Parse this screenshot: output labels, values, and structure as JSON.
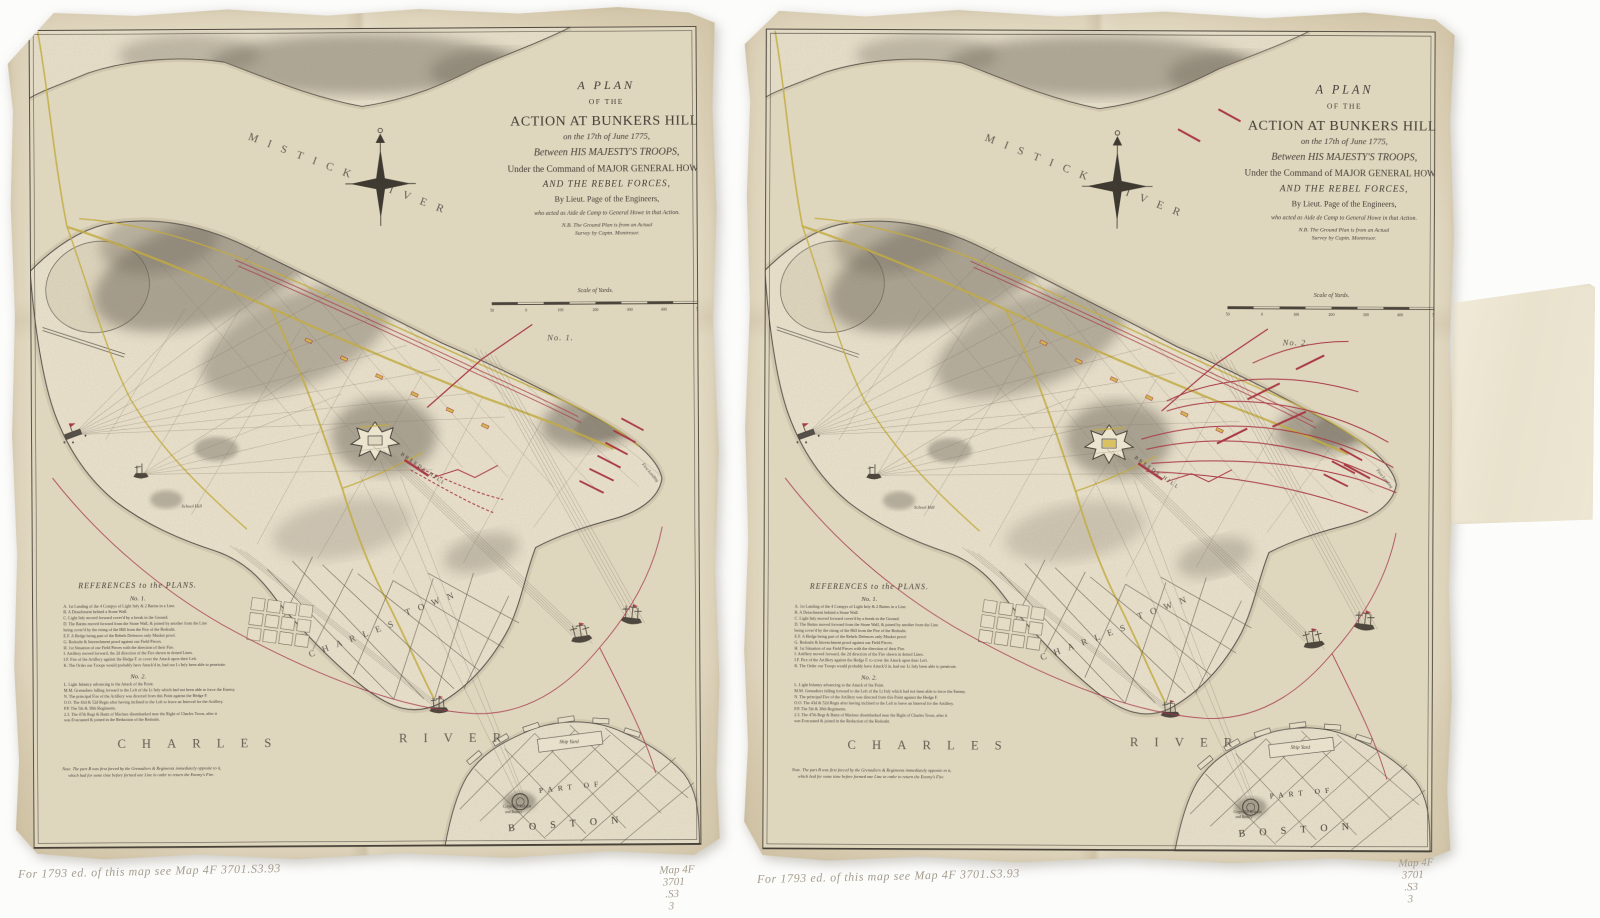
{
  "photo": {
    "background": "#fcfcfb",
    "paper_color": "#e6ddc6"
  },
  "sheet": {
    "title": {
      "lines": [
        "A PLAN",
        "OF THE",
        "ACTION AT BUNKERS HILL,",
        "on the 17th of June 1775,",
        "Between HIS MAJESTY'S TROOPS,",
        "Under the Command of MAJOR GENERAL HOWE,",
        "AND THE REBEL FORCES,",
        "By Lieut. Page of the Engineers,",
        "who acted as Aide de Camp to General Howe in that Action.",
        "N.B. The Ground Plan is from an Actual",
        "Survey by Captn. Montresor."
      ]
    },
    "scale": {
      "label": "Scale of Yards.",
      "ticks": [
        "50",
        "0",
        "100",
        "200",
        "300",
        "400",
        "500"
      ]
    },
    "labels": {
      "mistick_river": "MISTICK RIVER",
      "charles_word": "CHARLES",
      "river_word": "RIVER",
      "charles_town_1": "CHARLES",
      "charles_town_2": "TOWN",
      "breeds_hill": "BREEDS HILL",
      "school_hill": "School Hill",
      "first_landing": "First Landing",
      "ship_yard": "Ship Yard",
      "part_of": "PART OF",
      "boston": "BOSTON",
      "corps_hill_1": "Corps Hill Redoubt",
      "corps_hill_2": "and Battery"
    },
    "references": {
      "heading": "REFERENCES to the PLANS.",
      "no1_heading": "No. 1.",
      "no1": [
        "A. 1st Landing of the 4 Compys of Light Infy & 2 Battns in a Line.",
        "B. A Detachment behind a Stone Wall.",
        "C. Light Infy moved forward cover'd by a break in the Ground.",
        "D. The Battns moved forward from the Stone Wall, & joined by another from the Line",
        "      being cover'd by the rising of the Hill from the Fire of the Redoubt.",
        "E.F. A Hedge being part of the Rebels Defences only Musket proof.",
        "G. Redoubt & Intrenchment proof against our Field Pieces.",
        "H. 1st Situation of our Field Pieces with the direction of their Fire.",
        "I. Artillery moved forward, the 2d direction of the Fire shewn in dotted Lines.",
        "I.F. Fire of the Artillery against the Hedge F. to cover the Attack upon their Left.",
        "K. The Order our Troops would probably have Attack'd in, had our Lt Infy been able to penetrate."
      ],
      "no2_heading": "No. 2.",
      "no2": [
        "L. Light Infantry advancing to the Attack of the Point.",
        "M.M. Grenadiers falling forward to the Left of the Lt Infy which had not been able to force the Enemy.",
        "N. The principal Fire of the Artillery was directed from this Point against the Hedge F.",
        "O.O. The 43d & 52d Regts after having inclined to the Left to leave an Interval for the Artillery.",
        "P.P. The 5th & 38th Regiments.",
        "2.3. The 47th Regt & Battn of Marines disembarked near the Right of Charles Town, after it",
        "      was Evacuated & joined in the Reduction of the Redoubt."
      ],
      "note_1": "Note. The part B was first forced by the Grenadiers & Regiments immediately opposite to it,",
      "note_2": "which had for some time before formed one Line in order to return the Enemy's Fire."
    }
  },
  "sheets": [
    {
      "plan_label": "No. 1."
    },
    {
      "plan_label": "No. 2."
    }
  ],
  "annotations": {
    "pencil_note": "For 1793 ed. of this map see Map 4F 3701.S3.93",
    "catalog_lines": [
      "Map 4F",
      "3701",
      ".S3",
      "3"
    ]
  },
  "colors": {
    "ink": "#4c463d",
    "troop_red": "#a93a45",
    "road_yellow": "#c2ab42",
    "pencil_gray": "#a49c8d"
  }
}
